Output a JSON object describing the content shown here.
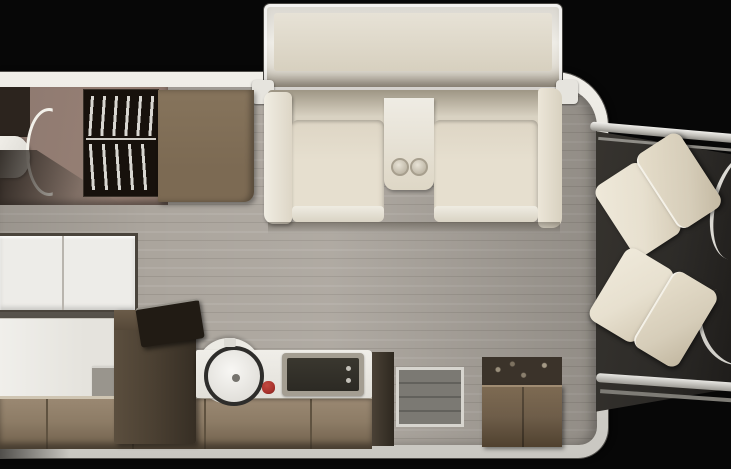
{
  "meta": {
    "title": "Motorhome floor plan — top-down view",
    "view": "top-down",
    "orientation": "rear at left, driver cab at right"
  },
  "colors": {
    "bg": "#070707",
    "shell": "#dedcd6",
    "shell-bright": "#f1efe9",
    "floor": "#aba59d",
    "floor-line": "#9d978f",
    "bath-wall": "#8d7970",
    "bath-dark": "#2c241e",
    "wardrobe-dark": "#17110c",
    "clothes-white": "#e9e7e2",
    "panel-brown": "#7c6a53",
    "sofa-cream": "#e6dfcf",
    "sofa-bright": "#f0ede3",
    "bed-white": "#edece8",
    "bed-frame": "#4a443c",
    "bed-lower": "#e5e3dd",
    "cabinet-dark": "#4c4133",
    "cabinet-brown": "#8d7c66",
    "cabinet-edge": "#cfc5b2",
    "counter-white": "#eceae4",
    "sink-ring": "#2e2d2b",
    "stove-dark": "#2c2a24",
    "stove-frame": "#a49e92",
    "knob-red": "#a9332d",
    "tv-black": "#211b14",
    "mat-gray": "#7b7973",
    "entry-top": "#3b332a",
    "entry-brown": "#6e5d49",
    "cab-floor": "#2d2b28",
    "trim-silver": "#c2c0ba",
    "seat-cream": "#e7e0cf",
    "seat-shade": "#d6cdb9"
  },
  "floorplan": {
    "slideout_label": "Sofa slide-out box",
    "areas": [
      {
        "id": "bathroom",
        "label": "Rear bathroom with curved shower door and toilet"
      },
      {
        "id": "wardrobe",
        "label": "Wardrobe closet with hanging clothes",
        "visible_hangers": 7
      },
      {
        "id": "sofa",
        "label": "Slide-out sofa with center console",
        "seats": 2,
        "cupholders": 2
      },
      {
        "id": "beds",
        "label": "Beds along rear curb side",
        "count": 2
      },
      {
        "id": "kitchen",
        "label": "Galley kitchen",
        "features": [
          "tall refrigerator cabinet",
          "TV on cabinet",
          "round sink",
          "cooktop",
          "red knob"
        ]
      },
      {
        "id": "entry",
        "label": "Entry area with step mat and cabinet"
      },
      {
        "id": "cab",
        "label": "Driver cab with swivel captain seats",
        "seats": 2
      }
    ]
  }
}
